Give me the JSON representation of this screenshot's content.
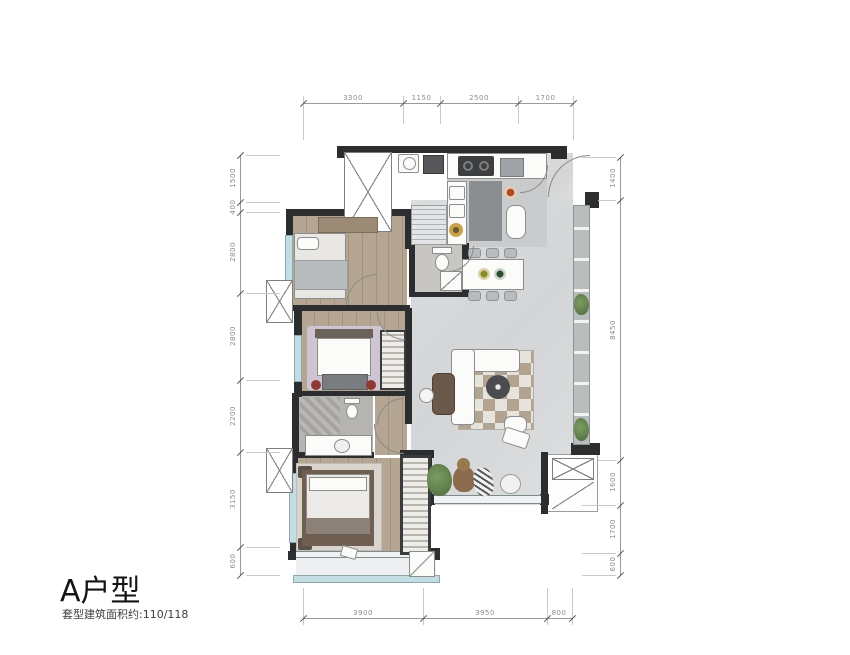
{
  "title_block": {
    "name": "A户型",
    "area_note": "套型建筑面积约:110/118"
  },
  "dimensions": {
    "unit": "mm",
    "top": [
      "3300",
      "1150",
      "2500",
      "1700"
    ],
    "bottom": [
      "3900",
      "3950",
      "800"
    ],
    "left": [
      "1500",
      "400",
      "2800",
      "2800",
      "2200",
      "3150",
      "600"
    ],
    "right": [
      "1400",
      "8450",
      "1600",
      "1700",
      "600"
    ]
  },
  "colors": {
    "wall": "#2c2d2f",
    "wood_floor": "#b5a593",
    "living_floor": "#d8dadb",
    "glass": "#c3dde4",
    "rug_purple": "#cfc5d2",
    "pillow_red": "#8e3a34",
    "plant_green": "#5c7d4e",
    "dim_text": "#8c8c8c"
  }
}
